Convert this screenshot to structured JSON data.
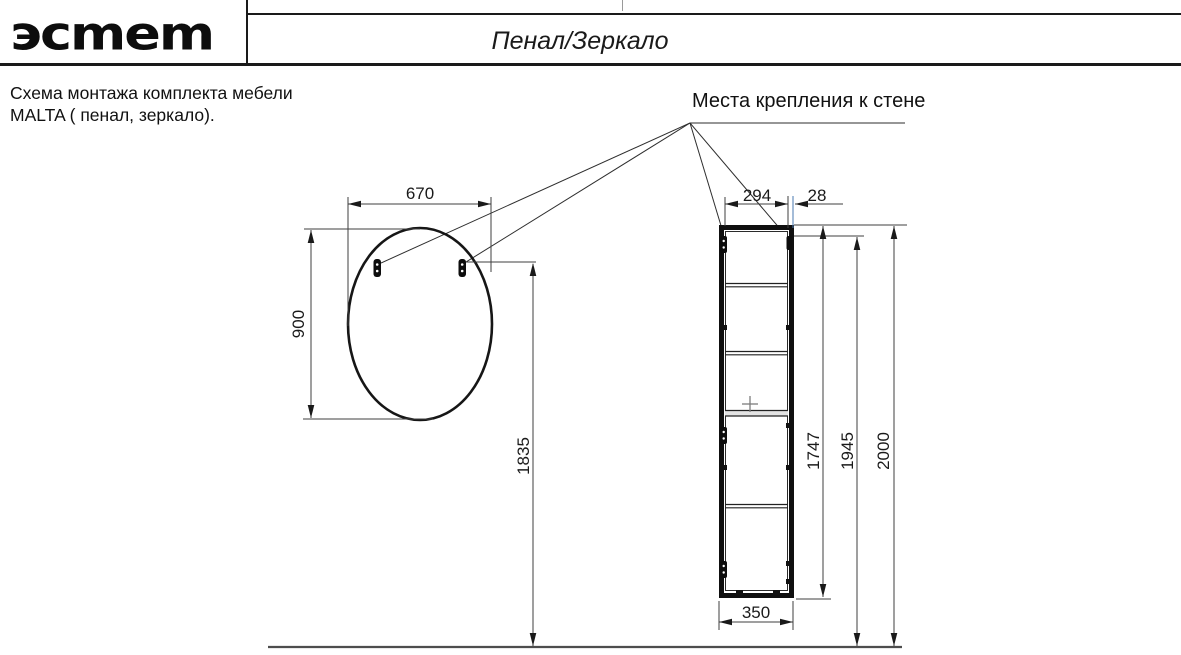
{
  "header": {
    "logo": {
      "brand": "эстет",
      "display": "эсmem"
    },
    "title": "Пенал/Зеркало"
  },
  "note": {
    "line1": "Схема монтажа комплекта мебели",
    "line2": "MALTA  ( пенал, зеркало)."
  },
  "callout_label": "Места крепления к стене",
  "mirror": {
    "width_mm": "670",
    "height_mm": "900",
    "bracket_height_mm": "1835"
  },
  "cabinet": {
    "bracket_span_mm": "294",
    "bracket_edge_offset_mm": "28",
    "height_mm": "1747",
    "bracket_from_floor_mm": "1945",
    "top_from_floor_mm": "2000",
    "width_mm": "350"
  },
  "colors": {
    "line": "#1a1a1a",
    "dim_line": "#3f3f3f",
    "accent_blue": "#4a7ab0",
    "floor": "#4d4d4d"
  }
}
